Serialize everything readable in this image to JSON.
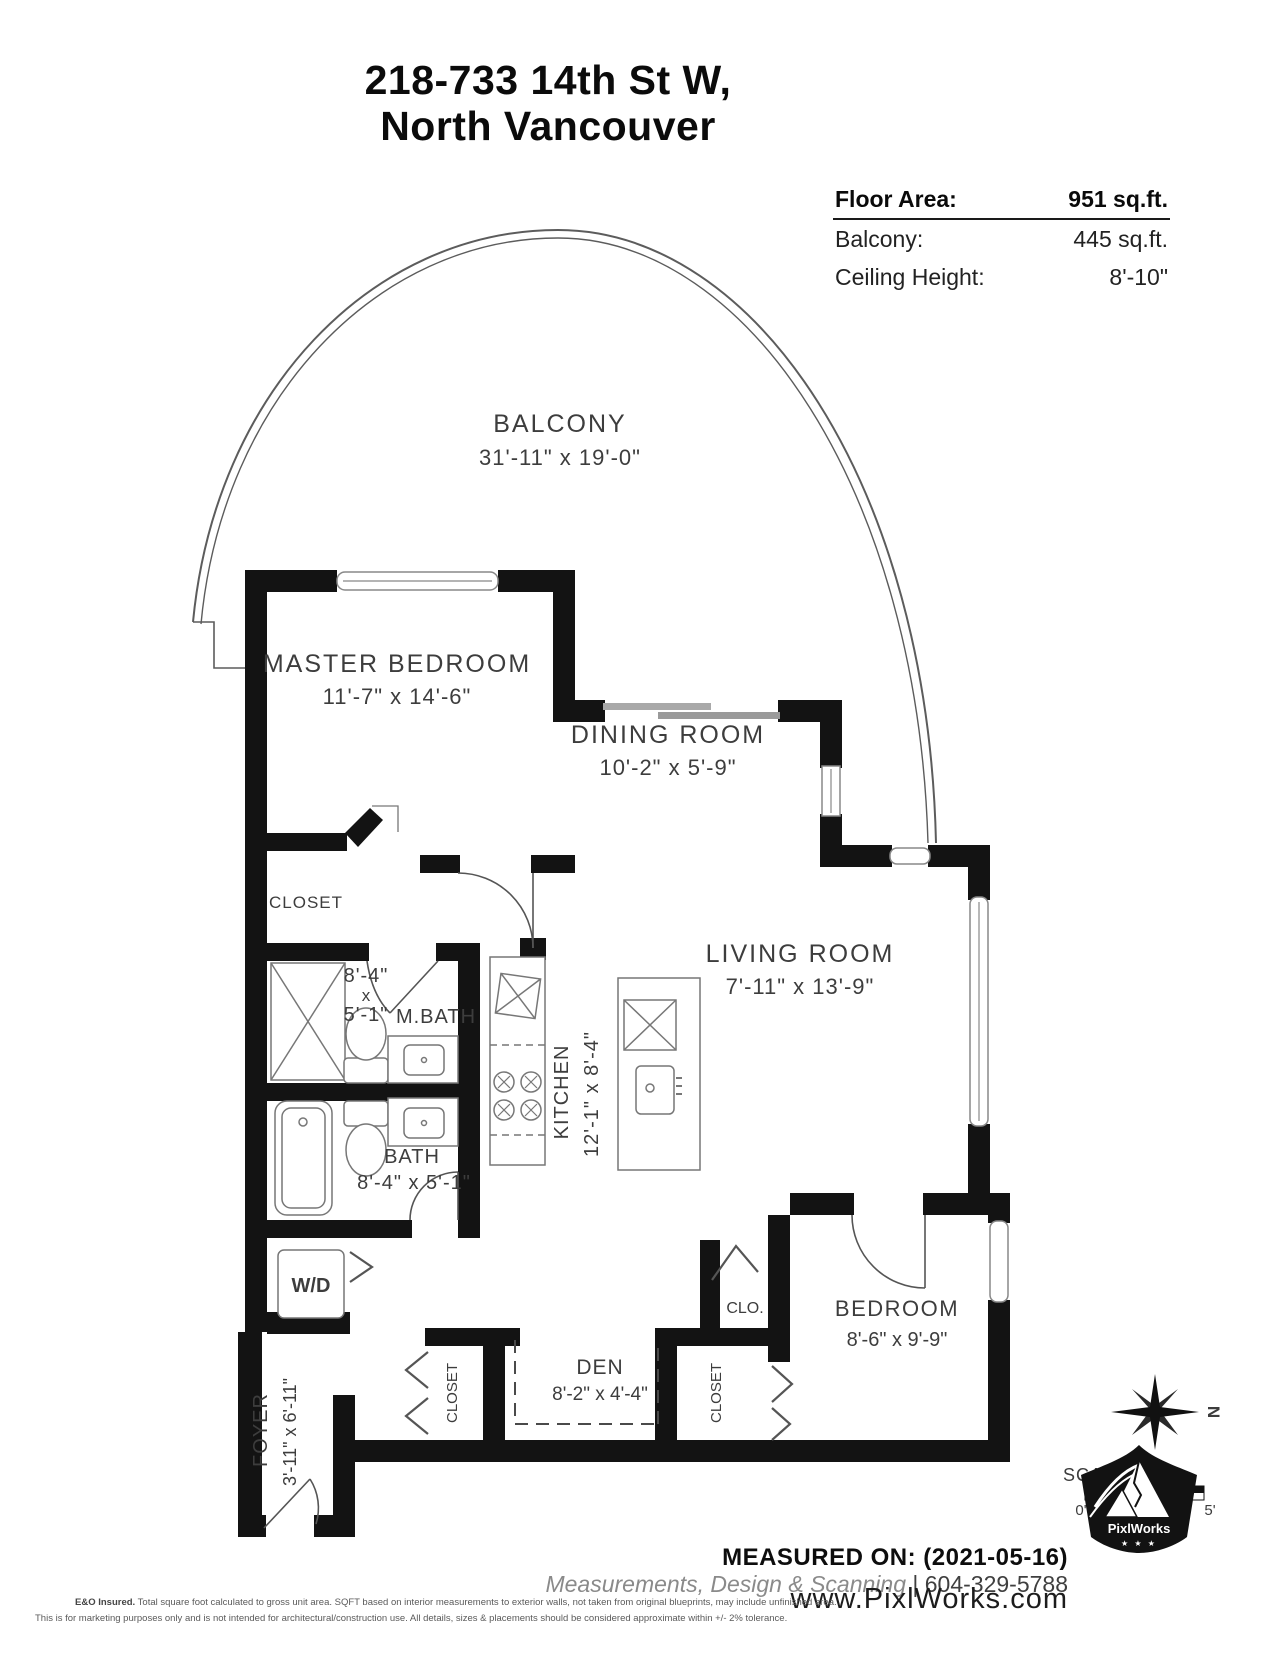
{
  "title": {
    "line1": "218-733 14th St W,",
    "line2": "North Vancouver"
  },
  "info": {
    "rows": [
      {
        "label": "Floor Area:",
        "value": "951 sq.ft."
      },
      {
        "label": "Balcony:",
        "value": "445 sq.ft."
      },
      {
        "label": "Ceiling Height:",
        "value": "8'-10\""
      }
    ]
  },
  "rooms": {
    "balcony": {
      "name": "BALCONY",
      "dims": "31'-11\" x 19'-0\""
    },
    "master": {
      "name": "MASTER BEDROOM",
      "dims": "11'-7\" x 14'-6\""
    },
    "dining": {
      "name": "DINING ROOM",
      "dims": "10'-2\" x 5'-9\""
    },
    "living": {
      "name": "LIVING ROOM",
      "dims": "7'-11\" x 13'-9\""
    },
    "mbath": {
      "name": "M.BATH",
      "w": "8'-4\"",
      "sep": "x",
      "h": "5'-1\""
    },
    "bath": {
      "name": "BATH",
      "dims": "8'-4\" x 5'-1\""
    },
    "kitchen": {
      "name": "KITCHEN",
      "dims": "12'-1\" x 8'-4\""
    },
    "closet_master": {
      "name": "CLOSET"
    },
    "wd": {
      "name": "W/D"
    },
    "foyer": {
      "name": "FOYER",
      "dims": "3'-11\" x 6'-11\""
    },
    "den": {
      "name": "DEN",
      "dims": "8'-2\" x 4'-4\""
    },
    "clo": {
      "name": "CLO."
    },
    "closet_hall": {
      "name": "CLOSET"
    },
    "closet_bedroom": {
      "name": "CLOSET"
    },
    "bedroom": {
      "name": "BEDROOM",
      "dims": "8'-6\" x 9'-9\""
    }
  },
  "scale": {
    "label": "SCALE",
    "start": "0'",
    "end": "5'"
  },
  "compass": {
    "north": "N"
  },
  "footer": {
    "measured_on": "MEASURED ON: (2021-05-16)",
    "tagline": "Measurements, Design & Scanning",
    "separator": "|",
    "phone": "604-329-5788",
    "website": "www.PixlWorks.com",
    "logo_text": "PixlWorks",
    "logo_stars": "★ ★ ★",
    "disclaimer_bold": "E&O Insured.",
    "disclaimer1": "Total square foot calculated to gross unit area. SQFT based on interior measurements to exterior walls, not taken from original blueprints, may include unfinished area.",
    "disclaimer2": "This is for marketing purposes only and is not intended for architectural/construction use.  All details, sizes & placements should be considered approximate within +/- 2%  tolerance."
  },
  "colors": {
    "wall": "#131313",
    "line": "#5c5c5c",
    "label": "#3d3d3d"
  }
}
